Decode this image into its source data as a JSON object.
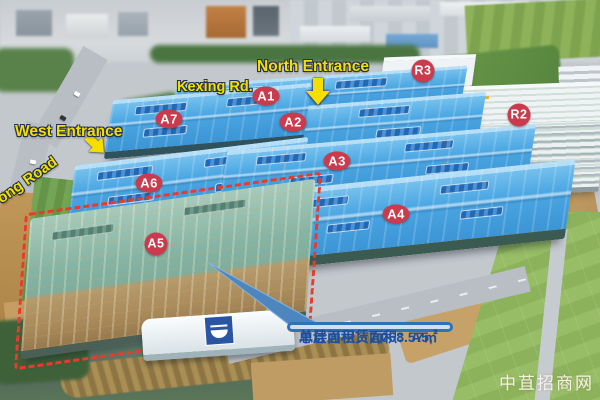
{
  "map": {
    "building_labels": [
      {
        "id": "A1",
        "text": "A1"
      },
      {
        "id": "A2",
        "text": "A2"
      },
      {
        "id": "A3",
        "text": "A3"
      },
      {
        "id": "A4",
        "text": "A4"
      },
      {
        "id": "A5",
        "text": "A5"
      },
      {
        "id": "A6",
        "text": "A6"
      },
      {
        "id": "A7",
        "text": "A7"
      },
      {
        "id": "R2",
        "text": "R2"
      },
      {
        "id": "R3",
        "text": "R3"
      }
    ],
    "annotations": {
      "north_entrance": "North Entrance",
      "west_entrance": "West Entrance",
      "kexing_road": "Kexing Rd.",
      "left_road": "ong Road"
    }
  },
  "callout": {
    "line1": "单层可租赁面积：A5,",
    "line2": "总计面积：7,068.57㎡"
  },
  "watermark": "中苴招商网",
  "colors": {
    "label_red": "#c93b4d",
    "annotation_yellow": "#f6df00",
    "callout_border": "#2e74b5",
    "callout_fill": "#cfe0f2",
    "callout_text": "#1d4fa1",
    "a5_outline": "#ea3a2c",
    "roof_blue": "#4aa6e2",
    "highlight_roof_teal": "#86b4a4"
  }
}
